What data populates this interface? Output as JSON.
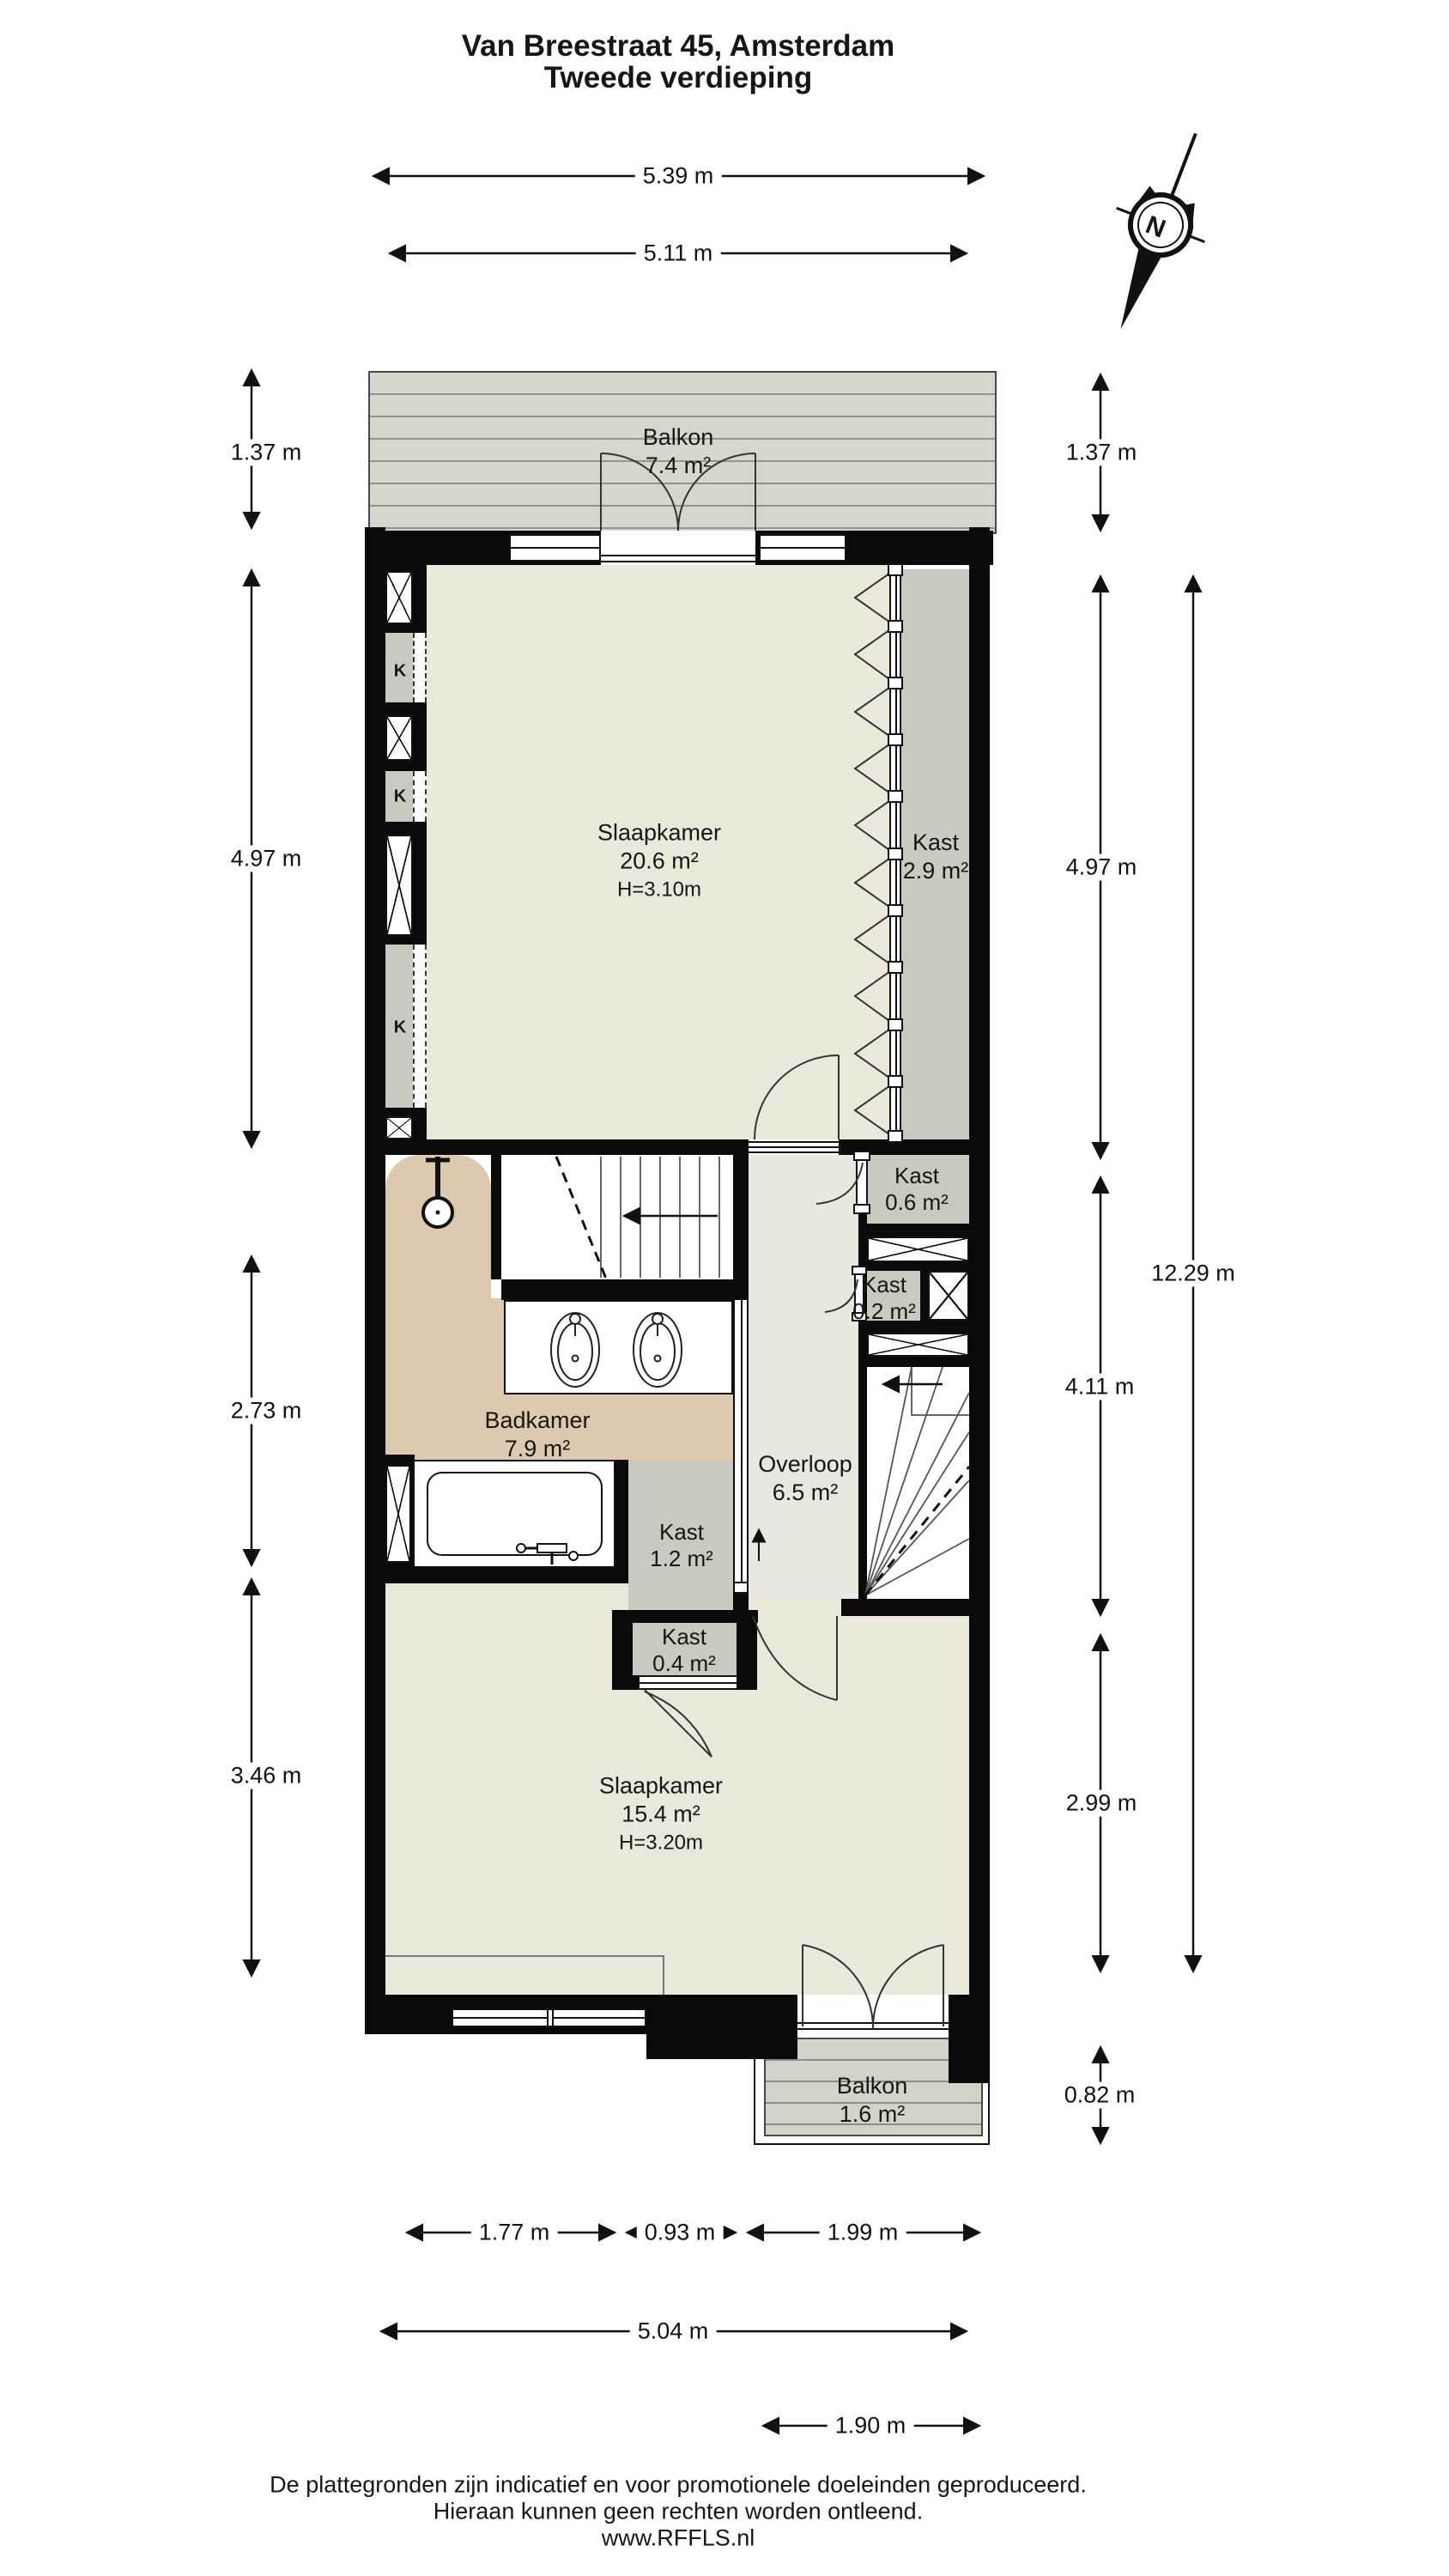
{
  "title": {
    "line1": "Van Breestraat 45, Amsterdam",
    "line2": "Tweede verdieping"
  },
  "compass": {
    "north_label": "N"
  },
  "rooms": {
    "balkon_top": {
      "name": "Balkon",
      "area": "7.4 m²"
    },
    "slaapkamer_1": {
      "name": "Slaapkamer",
      "area": "20.6 m²",
      "height": "H=3.10m"
    },
    "kast_29": {
      "name": "Kast",
      "area": "2.9 m²"
    },
    "kast_06": {
      "name": "Kast",
      "area": "0.6 m²"
    },
    "kast_02": {
      "name": "Kast",
      "area": "0.2 m²"
    },
    "badkamer": {
      "name": "Badkamer",
      "area": "7.9 m²"
    },
    "overloop": {
      "name": "Overloop",
      "area": "6.5 m²"
    },
    "kast_12": {
      "name": "Kast",
      "area": "1.2 m²"
    },
    "kast_04": {
      "name": "Kast",
      "area": "0.4 m²"
    },
    "slaapkamer_2": {
      "name": "Slaapkamer",
      "area": "15.4 m²",
      "height": "H=3.20m"
    },
    "balkon_bottom": {
      "name": "Balkon",
      "area": "1.6 m²"
    }
  },
  "wall_labels": {
    "k1": "K",
    "k2": "K",
    "k3": "K"
  },
  "dimensions": {
    "top_outer": "5.39 m",
    "top_inner": "5.11 m",
    "left_1": "1.37 m",
    "left_2": "4.97 m",
    "left_3": "2.73 m",
    "left_4": "3.46 m",
    "right_1": "1.37 m",
    "right_2": "4.97 m",
    "right_3": "4.11 m",
    "right_4": "2.99 m",
    "right_5": "0.82 m",
    "right_total": "12.29 m",
    "bottom_1": "1.77 m",
    "bottom_2": "0.93 m",
    "bottom_3": "1.99 m",
    "bottom_4": "5.04 m",
    "bottom_5": "1.90 m"
  },
  "footer": {
    "line1": "De plattegronden zijn indicatief en voor promotionele doeleinden geproduceerd.",
    "line2": "Hieraan kunnen geen rechten worden ontleend.",
    "line3": "www.RFFLS.nl"
  },
  "colors": {
    "wall": "#0a0a0a",
    "bedroom_floor": "#ebe7d9",
    "bathroom_floor": "#ddc9ad",
    "closet_floor": "#c9c9c0",
    "landing_floor": "#e8e6de",
    "deck": "#d8d5ca",
    "deck_line": "#96948a"
  }
}
